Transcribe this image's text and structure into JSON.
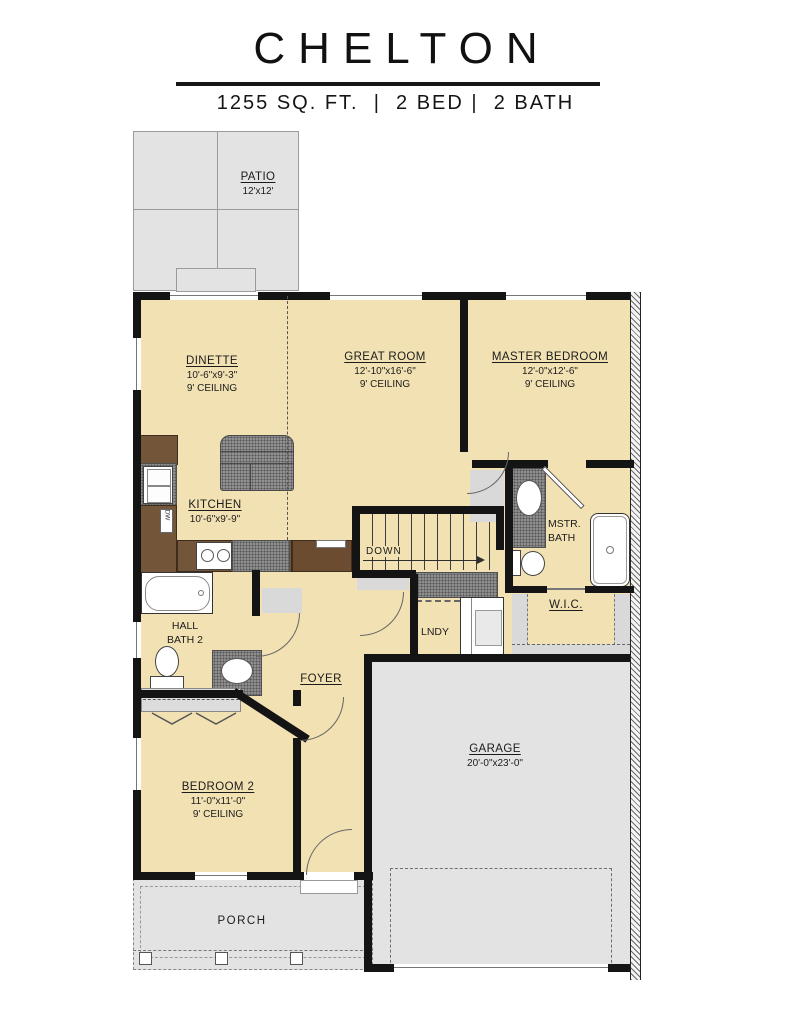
{
  "header": {
    "title": "CHELTON",
    "subtitle": "1255 SQ. FT.  |  2 BED |  2 BATH"
  },
  "colors": {
    "floor": "#f2e2b3",
    "surface": "#e3e3e3",
    "wall": "#141414",
    "counter": "#73553a",
    "carpet": "#8d8d8d",
    "line": "#666666"
  },
  "rooms": {
    "patio": {
      "name": "PATIO",
      "dims": "12'x12'"
    },
    "dinette": {
      "name": "DINETTE",
      "dims": "10'-6\"x9'-3\"",
      "ceiling": "9' CEILING"
    },
    "great_room": {
      "name": "GREAT ROOM",
      "dims": "12'-10\"x16'-6\"",
      "ceiling": "9' CEILING"
    },
    "master_bedroom": {
      "name": "MASTER BEDROOM",
      "dims": "12'-0\"x12'-6\"",
      "ceiling": "9' CEILING"
    },
    "kitchen": {
      "name": "KITCHEN",
      "dims": "10'-6\"x9'-9\""
    },
    "mstr_bath": {
      "line1": "MSTR.",
      "line2": "BATH"
    },
    "wic": {
      "name": "W.I.C."
    },
    "lndy": {
      "name": "LNDY"
    },
    "hall_bath": {
      "line1": "HALL",
      "line2": "BATH 2"
    },
    "foyer": {
      "name": "FOYER"
    },
    "bedroom2": {
      "name": "BEDROOM 2",
      "dims": "11'-0\"x11'-0\"",
      "ceiling": "9' CEILING"
    },
    "garage": {
      "name": "GARAGE",
      "dims": "20'-0\"x23'-0\""
    },
    "porch": {
      "name": "PORCH"
    }
  },
  "annotations": {
    "stairs_direction": "DOWN",
    "dishwasher": "DW"
  }
}
